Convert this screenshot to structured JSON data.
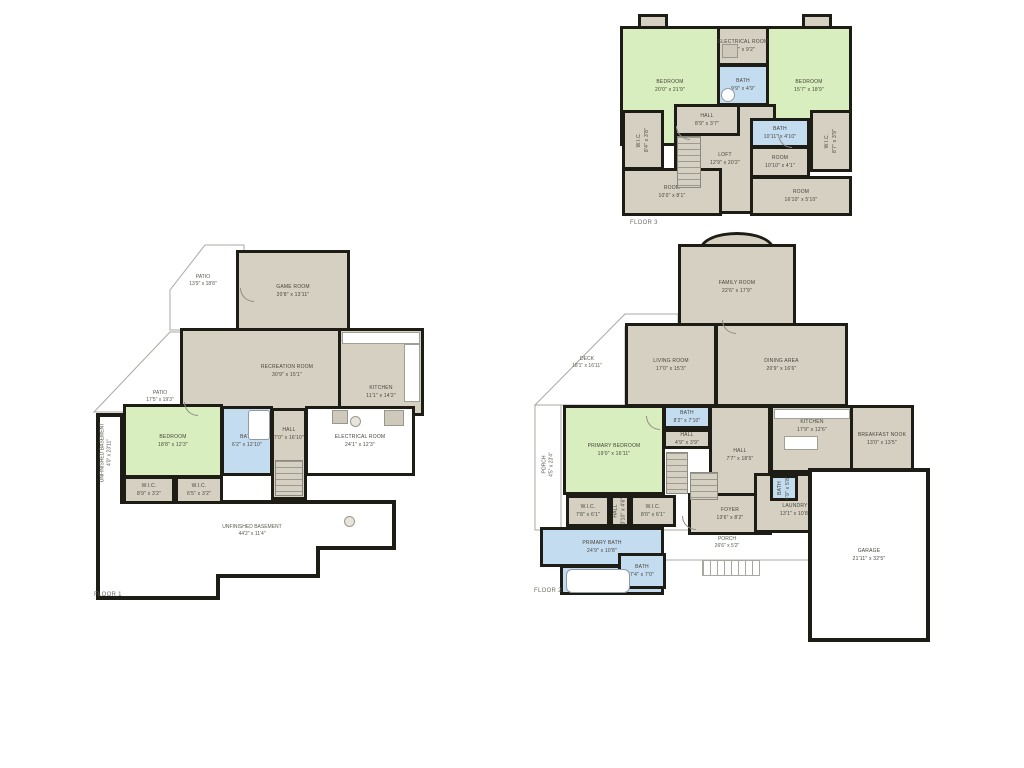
{
  "colors": {
    "wall": "#1d1d16",
    "room_tan": "#d6d0c3",
    "room_green": "#d9eebe",
    "room_blue": "#c4dcf0",
    "outline_gray": "#a8a8a0",
    "background": "#ffffff"
  },
  "floors": {
    "f1": {
      "label": "FLOOR 1",
      "rooms": {
        "patio_upper": {
          "name": "PATIO",
          "dims": "13'9\" x 18'8\""
        },
        "game_room": {
          "name": "GAME ROOM",
          "dims": "20'8\" x 13'11\""
        },
        "recreation_room": {
          "name": "RECREATION ROOM",
          "dims": "30'9\" x 15'1\""
        },
        "kitchen": {
          "name": "KITCHEN",
          "dims": "11'1\" x 14'2\""
        },
        "patio_lower": {
          "name": "PATIO",
          "dims": "17'5\" x 19'3\""
        },
        "bedroom": {
          "name": "BEDROOM",
          "dims": "18'8\" x 12'3\""
        },
        "bath": {
          "name": "BATH",
          "dims": "6'2\" x 12'10\""
        },
        "hall": {
          "name": "HALL",
          "dims": "7'0\" x 16'10\""
        },
        "electrical_room": {
          "name": "ELECTRICAL ROOM",
          "dims": "24'1\" x 12'3\""
        },
        "wic_left": {
          "name": "W.I.C.",
          "dims": "8'9\" x 3'2\""
        },
        "wic_right": {
          "name": "W.I.C.",
          "dims": "6'5\" x 3'2\""
        },
        "basement": {
          "name": "UNFINISHED BASEMENT",
          "dims": "44'2\" x 11'4\""
        },
        "side_strip": {
          "name": "UNFINISHED BASEMENT",
          "dims": "4'0\" x 23'11\""
        }
      }
    },
    "f2": {
      "label": "FLOOR 2",
      "rooms": {
        "family_room": {
          "name": "FAMILY ROOM",
          "dims": "22'6\" x 17'9\""
        },
        "deck": {
          "name": "DECK",
          "dims": "18'1\" x 16'11\""
        },
        "living_room": {
          "name": "LIVING ROOM",
          "dims": "17'0\" x 15'3\""
        },
        "dining_area": {
          "name": "DINING AREA",
          "dims": "20'9\" x 16'6\""
        },
        "kitchen": {
          "name": "KITCHEN",
          "dims": "17'9\" x 12'6\""
        },
        "breakfast_nook": {
          "name": "BREAKFAST NOOK",
          "dims": "13'0\" x 13'5\""
        },
        "primary_bedroom": {
          "name": "PRIMARY BEDROOM",
          "dims": "19'0\" x 16'11\""
        },
        "bath_upper": {
          "name": "BATH",
          "dims": "8'2\" x 7'10\""
        },
        "hall_small": {
          "name": "HALL",
          "dims": "4'9\" x 3'9\""
        },
        "hall_center": {
          "name": "HALL",
          "dims": "7'7\" x 18'5\""
        },
        "wic_left": {
          "name": "W.I.C.",
          "dims": "7'8\" x 6'1\""
        },
        "hall_wic": {
          "name": "HALL",
          "dims": "3'10\" x 4'6\""
        },
        "wic_right": {
          "name": "W.I.C.",
          "dims": "8'0\" x 6'1\""
        },
        "foyer": {
          "name": "FOYER",
          "dims": "13'6\" x 8'2\""
        },
        "laundry": {
          "name": "LAUNDRY",
          "dims": "13'1\" x 10'8\""
        },
        "bath_laundry": {
          "name": "BATH",
          "dims": "4'9\" x 5'8\""
        },
        "primary_bath": {
          "name": "PRIMARY BATH",
          "dims": "24'9\" x 10'8\""
        },
        "bath_lower": {
          "name": "BATH",
          "dims": "7'4\" x 7'0\""
        },
        "porch": {
          "name": "PORCH",
          "dims": "26'6\" x 5'2\""
        },
        "garage": {
          "name": "GARAGE",
          "dims": "21'11\" x 32'5\""
        },
        "side_porch": {
          "name": "PORCH",
          "dims": "4'5\" x 23'4\""
        }
      }
    },
    "f3": {
      "label": "FLOOR 3",
      "rooms": {
        "bedroom_left": {
          "name": "BEDROOM",
          "dims": "20'0\" x 21'9\""
        },
        "electrical_room": {
          "name": "ELECTRICAL ROOM",
          "dims": "8'1\" x 9'2\""
        },
        "bath_center": {
          "name": "BATH",
          "dims": "9'9\" x 4'9\""
        },
        "bedroom_right": {
          "name": "BEDROOM",
          "dims": "15'7\" x 18'9\""
        },
        "hall": {
          "name": "HALL",
          "dims": "8'9\" x 3'7\""
        },
        "bath_right": {
          "name": "BATH",
          "dims": "10'11\" x 4'10\""
        },
        "loft": {
          "name": "LOFT",
          "dims": "12'9\" x 20'2\""
        },
        "room_mid_right": {
          "name": "ROOM",
          "dims": "10'10\" x 4'1\""
        },
        "wic_left": {
          "name": "W.I.C.",
          "dims": "8'4\" x 3'8\""
        },
        "wic_right": {
          "name": "W.I.C.",
          "dims": "8'7\" x 3'9\""
        },
        "room_bottom_left": {
          "name": "ROOM",
          "dims": "10'0\" x 8'1\""
        },
        "room_bottom_right": {
          "name": "ROOM",
          "dims": "16'10\" x 5'10\""
        }
      }
    }
  }
}
